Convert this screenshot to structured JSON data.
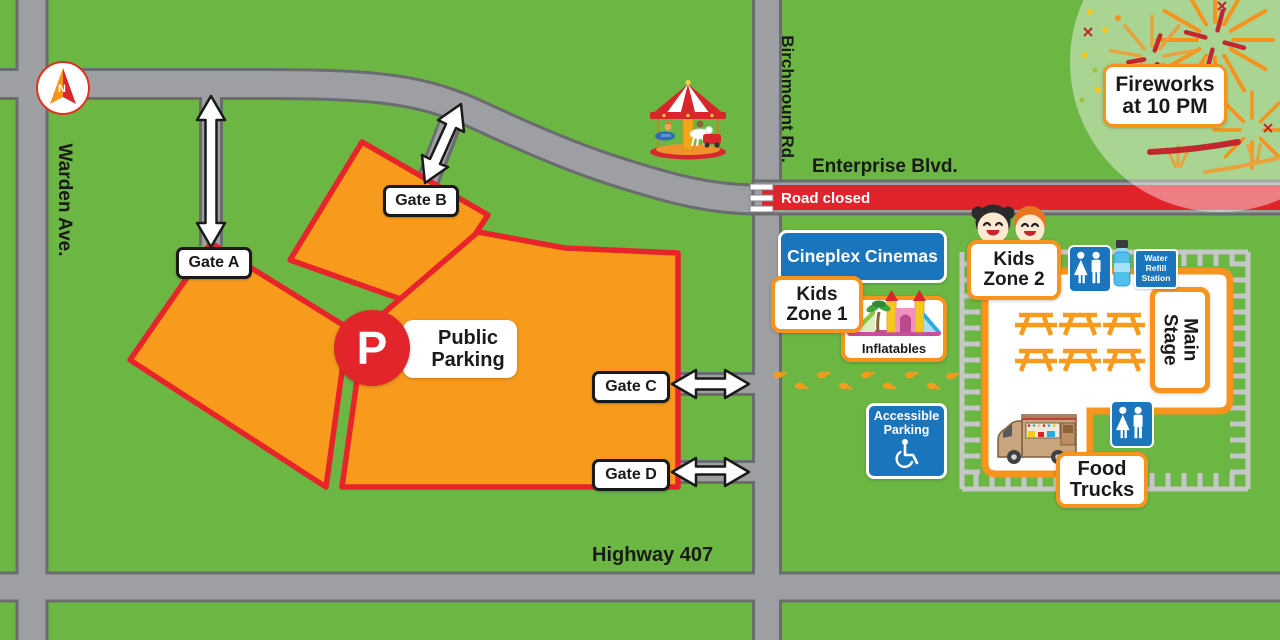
{
  "roads": {
    "warden": "Warden Ave.",
    "birchmount": "Birchmount Rd.",
    "enterprise": "Enterprise Blvd.",
    "highway": "Highway 407",
    "road_closed": "Road closed"
  },
  "compass": {
    "north": "N"
  },
  "gates": {
    "a": "Gate A",
    "b": "Gate B",
    "c": "Gate C",
    "d": "Gate D"
  },
  "parking": {
    "badge": "P",
    "label": [
      "Public",
      "Parking"
    ]
  },
  "fireworks": {
    "label": [
      "Fireworks",
      "at 10 PM"
    ]
  },
  "venues": {
    "cineplex": "Cineplex Cinemas",
    "kids_zone_1": [
      "Kids",
      "Zone 1"
    ],
    "kids_zone_2": [
      "Kids",
      "Zone 2"
    ],
    "inflatables": "Inflatables",
    "main_stage": [
      "Main",
      "Stage"
    ],
    "food_trucks": [
      "Food",
      "Trucks"
    ],
    "accessible_parking": [
      "Accessible",
      "Parking"
    ],
    "water_refill": [
      "Water",
      "Refill",
      "Station"
    ]
  },
  "colors": {
    "grass": "#6CB644",
    "road_fill": "#9D9FA2",
    "road_edge": "#6A6C6E",
    "lot_fill": "#F89B1C",
    "lot_border": "#E8242B",
    "accent_orange": "#F7941E",
    "closed_red": "#E1232B",
    "sign_blue": "#1B75BC",
    "badge_red": "#E1252B"
  }
}
